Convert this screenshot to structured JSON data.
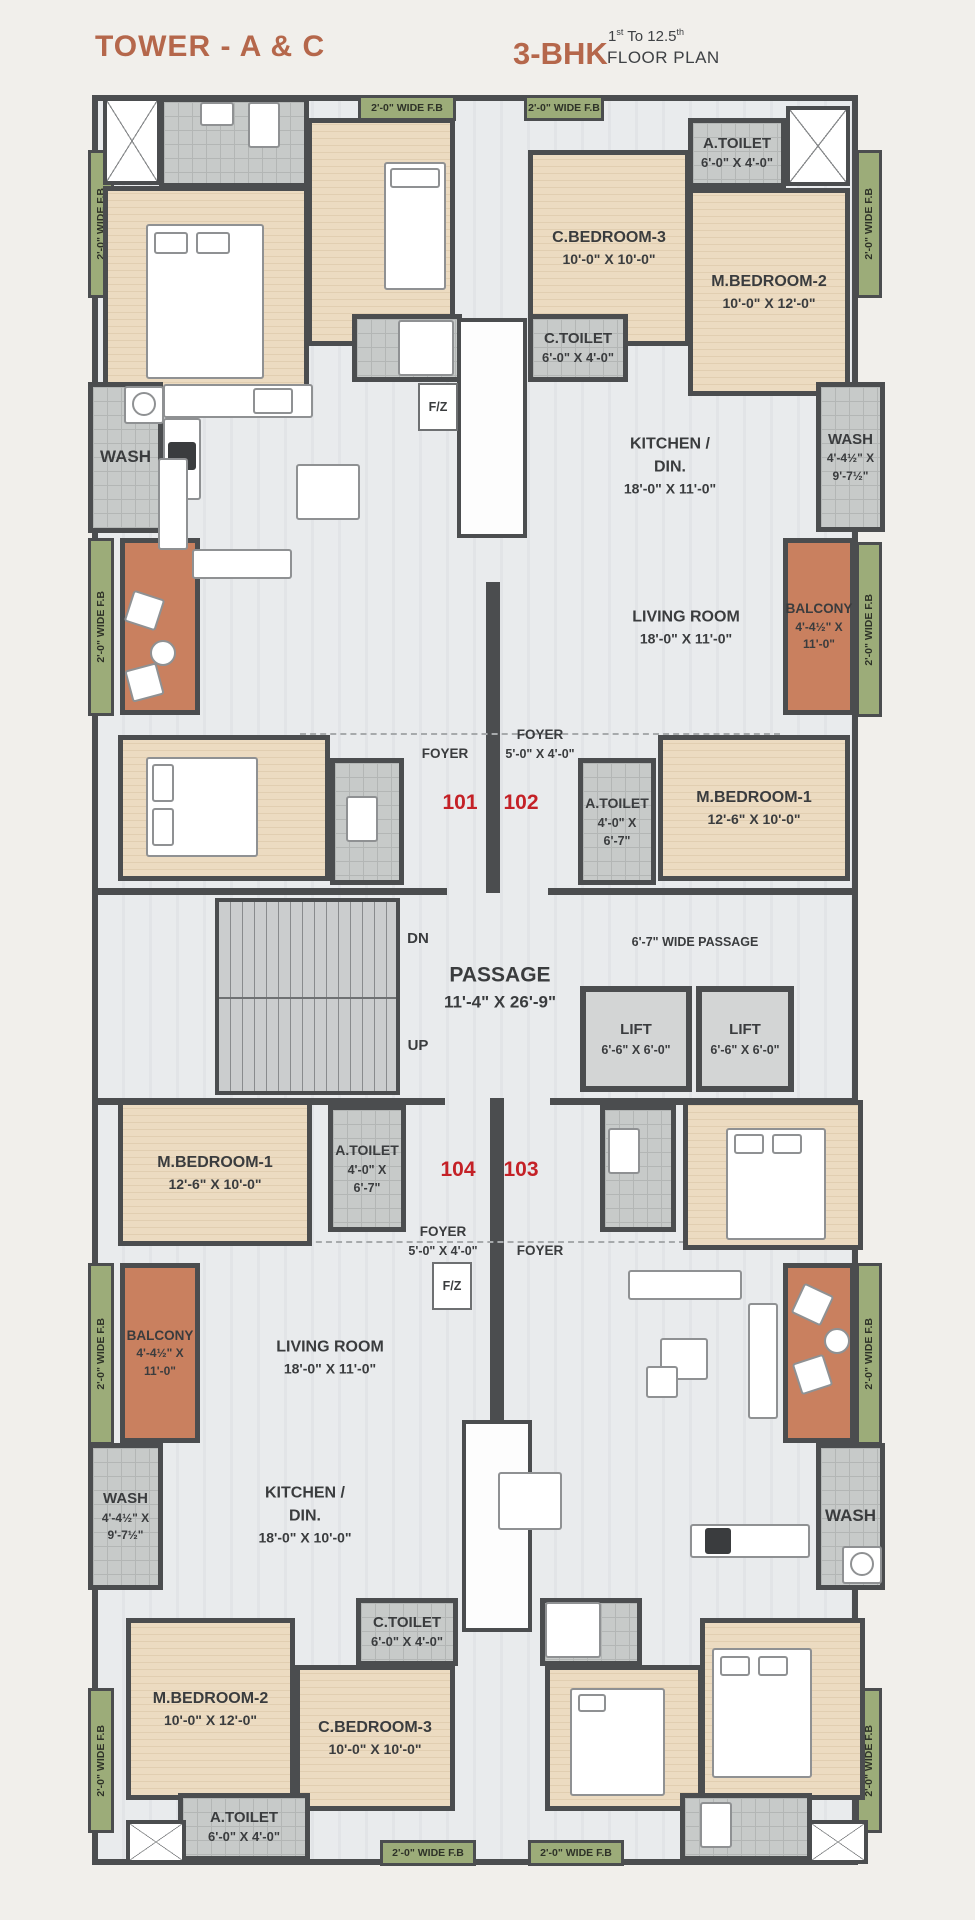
{
  "header": {
    "tower_title": "TOWER - A & C",
    "bhk": "3-BHK",
    "floor_from": "1",
    "floor_from_sup": "st",
    "floor_mid": " To ",
    "floor_to": "12.5",
    "floor_to_sup": "th",
    "plan_text": "FLOOR PLAN"
  },
  "unit_numbers": {
    "u101": "101",
    "u102": "102",
    "u103": "103",
    "u104": "104"
  },
  "rooms": {
    "a_toilet": {
      "name": "A.TOILET",
      "dims": "6'-0\" X 4'-0\""
    },
    "a_toilet_small": {
      "name": "A.TOILET",
      "dims1": "4'-0\" X",
      "dims2": "6'-7\""
    },
    "c_toilet": {
      "name": "C.TOILET",
      "dims": "6'-0\" X 4'-0\""
    },
    "c_bedroom3": {
      "name": "C.BEDROOM-3",
      "dims": "10'-0\" X 10'-0\""
    },
    "m_bedroom2": {
      "name": "M.BEDROOM-2",
      "dims": "10'-0\" X 12'-0\""
    },
    "m_bedroom1": {
      "name": "M.BEDROOM-1",
      "dims": "12'-6\" X 10'-0\""
    },
    "kitchen_top": {
      "line1": "KITCHEN /",
      "line2": "DIN.",
      "dims": "18'-0\" X 11'-0\""
    },
    "kitchen_bottom": {
      "line1": "KITCHEN /",
      "line2": "DIN.",
      "dims": "18'-0\" X 10'-0\""
    },
    "living_room": {
      "name": "LIVING ROOM",
      "dims": "18'-0\" X 11'-0\""
    },
    "wash": {
      "name": "WASH",
      "dims1": "4'-4½\" X",
      "dims2": "9'-7½\""
    },
    "balcony": {
      "name": "BALCONY",
      "dims1": "4'-4½\" X",
      "dims2": "11'-0\""
    },
    "foyer": {
      "name": "FOYER",
      "dims": "5'-0\" X 4'-0\""
    },
    "passage": {
      "name": "PASSAGE",
      "dims": "11'-4\" X 26'-9\""
    },
    "lift": {
      "name": "LIFT",
      "dims": "6'-6\" X 6'-0\""
    }
  },
  "labels": {
    "wide_passage": "6'-7\" WIDE PASSAGE",
    "dn": "DN",
    "up": "UP",
    "fz": "F/Z",
    "fb_strip": "2'-0\" WIDE F.B"
  },
  "colors": {
    "accent": "#b5674b",
    "unit_number_red": "#c42127",
    "wall": "#4b4d4f",
    "bedroom_floor": "#e8d8bd",
    "tile_floor": "#c7cac9",
    "fb_green": "#9cac79",
    "balcony_terracotta": "#c9805f"
  }
}
